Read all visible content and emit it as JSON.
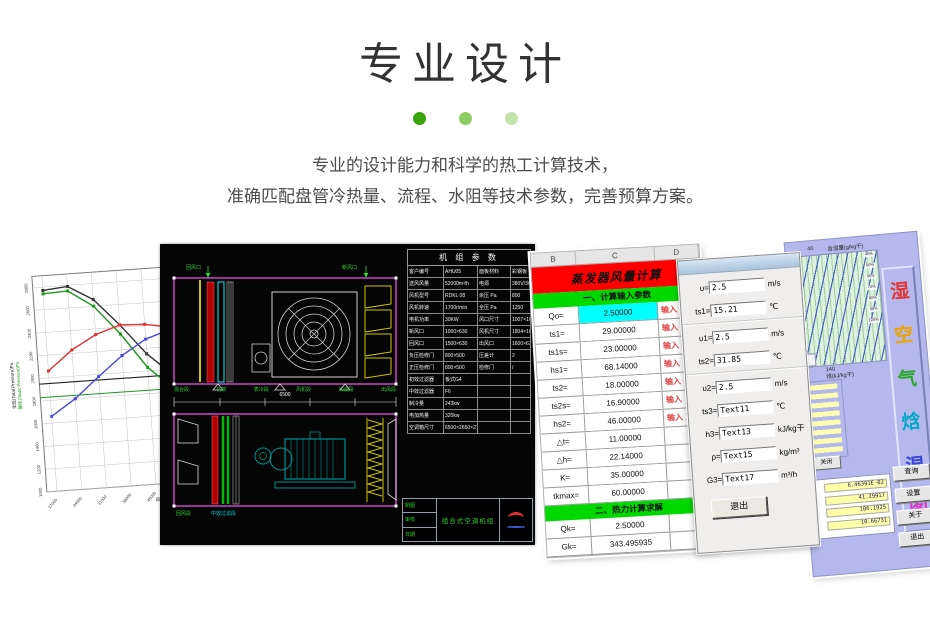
{
  "page": {
    "title": "专业设计",
    "dots": [
      {
        "color": "#3aa30b"
      },
      {
        "color": "#8fcc66"
      },
      {
        "color": "#c3e3a9"
      }
    ],
    "description_lines": [
      "专业的设计能力和科学的热工计算技术，",
      "准确匹配盘管冷热量、流程、水阻等技术参数，完善预算方案。"
    ]
  },
  "fan_chart": {
    "chart_data": {
      "type": "line",
      "title": "风机性能曲线",
      "xlabel": "风量(Volume)m³/h",
      "ylabel_left": "全压(Total Pressure)Pa",
      "ylabel_left2": "静压(Static Pressure)Pa",
      "x": [
        17000,
        24000,
        31000,
        38000,
        45000,
        52000
      ],
      "ylim": [
        1000,
        2900
      ],
      "y_ticks": [
        1000,
        1200,
        1400,
        1600,
        1800,
        2000,
        2200,
        2400,
        2600,
        2800
      ],
      "grid": true,
      "series": [
        {
          "name": "全压曲线",
          "color": "#333333",
          "values": [
            2770,
            2790,
            2660,
            2420,
            2150,
            1950
          ]
        },
        {
          "name": "静压曲线",
          "color": "#1a9a1a",
          "values": [
            2740,
            2750,
            2600,
            2340,
            2030,
            1830
          ]
        },
        {
          "name": "效率曲线",
          "color": "#e03030",
          "values": [
            2060,
            2230,
            2350,
            2420,
            2410,
            2370
          ]
        },
        {
          "name": "功率曲线",
          "color": "#4848e0",
          "values": [
            1660,
            1800,
            1980,
            2150,
            2280,
            2350
          ]
        }
      ],
      "ref_lines": {
        "total_pressure": 1950,
        "static_pressure": 1830,
        "flow": 52000
      }
    }
  },
  "cad": {
    "window_labels": {
      "left": "回风口",
      "right": "新风口"
    },
    "unit_top_labels": [
      {
        "text": "混合段",
        "color": "#2ecc2e"
      },
      {
        "text": "初效",
        "color": "#2ecc2e"
      },
      {
        "text": "表冷段",
        "color": "#2ecc2e"
      },
      {
        "text": "风机段",
        "color": "#2ecc2e"
      },
      {
        "text": "均流段",
        "color": "#2ecc2e"
      },
      {
        "text": "出风段",
        "color": "#2ecc2e"
      }
    ],
    "unit_bottom_labels": [
      {
        "text": "回风段",
        "color": "#2ecc2e"
      },
      {
        "text": "中效过滤段",
        "color": "#00cccc"
      }
    ],
    "dim_total": "6500",
    "table": {
      "title": "机 组 参 数",
      "rows": [
        [
          "客户编号",
          "AHU05",
          "面板材料",
          "彩钢板"
        ],
        [
          "送风风量",
          "52000m³/h",
          "电源",
          "380V/3/50"
        ],
        [
          "风机型号",
          "RDKL 08",
          "余压 Pa",
          "800"
        ],
        [
          "风机转速",
          "1700r/min",
          "全压 Pa",
          "1250"
        ],
        [
          "电机功率",
          "30KW",
          "风口尺寸",
          "1007×1007"
        ],
        [
          "新风口",
          "1000×630",
          "风机尺寸",
          "1804×1007"
        ],
        [
          "回风口",
          "1500×630",
          "出风口",
          "1600×630"
        ],
        [
          "负压检修门",
          "800×500",
          "压差计",
          "2"
        ],
        [
          "正压检修门",
          "800×500",
          "检修门",
          "/"
        ],
        [
          "初效过滤器",
          "板式G4",
          "",
          ""
        ],
        [
          "中效过滤器",
          "F6",
          "",
          ""
        ],
        [
          "制冷量",
          "243kw",
          "",
          ""
        ],
        [
          "电加热量",
          "320kw",
          "",
          ""
        ],
        [
          "空调箱尺寸",
          "6500×2650×2750(H)",
          "",
          ""
        ]
      ]
    },
    "title_block": {
      "cells": [
        "制图",
        "审核",
        "日期"
      ],
      "product": "组合式空调机组"
    }
  },
  "sheet": {
    "columns": [
      "B",
      "C",
      "D"
    ],
    "title": "蒸发器风量计算",
    "section1": "一、计算输入参数",
    "section2": "二、热力计算求解",
    "rows": [
      {
        "label": "Qo=",
        "value": "2.50000",
        "note": "输入",
        "bg": "#00ffff"
      },
      {
        "label": "ts1=",
        "value": "29.00000",
        "note": "输入",
        "bg": "#ffffff"
      },
      {
        "label": "ts1s=",
        "value": "23.00000",
        "note": "输入",
        "bg": "#ffffff"
      },
      {
        "label": "hs1=",
        "value": "68.14000",
        "note": "输入",
        "bg": "#ffffff"
      },
      {
        "label": "ts2=",
        "value": "18.00000",
        "note": "输入",
        "bg": "#ffffff"
      },
      {
        "label": "ts2s=",
        "value": "16.90000",
        "note": "输入",
        "bg": "#ffffff"
      },
      {
        "label": "hs2=",
        "value": "46.00000",
        "note": "输入",
        "bg": "#ffffff"
      },
      {
        "label": "△t=",
        "value": "11.00000",
        "note": "",
        "bg": "#ffffff"
      },
      {
        "label": "△h=",
        "value": "22.14000",
        "note": "",
        "bg": "#ffffff"
      },
      {
        "label": "K=",
        "value": "35.00000",
        "note": "",
        "bg": "#ffffff"
      },
      {
        "label": "tkmax=",
        "value": "60.00000",
        "note": "",
        "bg": "#ffffff"
      }
    ],
    "result_rows": [
      {
        "label": "Qk=",
        "value": "2.50000"
      },
      {
        "label": "Gk=",
        "value": "343.495935"
      }
    ]
  },
  "dialog": {
    "fields": [
      {
        "label": "υ=",
        "value": "2.5",
        "unit": "m/s"
      },
      {
        "label": "ts1=",
        "value": "15.21",
        "unit": "℃"
      },
      {
        "label": "υ1=",
        "value": "2.5",
        "unit": "m/s"
      },
      {
        "label": "ts2=",
        "value": "31.85",
        "unit": "℃"
      },
      {
        "label": "υ2=",
        "value": "2.5",
        "unit": "m/s"
      },
      {
        "label": "ts3=",
        "value": "Text11",
        "unit": "℃"
      },
      {
        "label": "h3=",
        "value": "Text13",
        "unit": "kJ/kg干"
      },
      {
        "label": "ρ=",
        "value": "Text15",
        "unit": "kg/m³"
      },
      {
        "label": "G3=",
        "value": "Text17",
        "unit": "m³/h"
      }
    ],
    "exit_button": "退出"
  },
  "psych": {
    "x_tick_top": "40",
    "top_label": "含湿量(g/kg干)",
    "enthalpy_tick": "140",
    "bottom_label": "焓(kJ/kg干)",
    "rh_labels": [
      "40%",
      "50%",
      "60%",
      "70%",
      "80%",
      "90%",
      "100%"
    ],
    "title_chars": [
      {
        "ch": "湿",
        "color": "#e23535"
      },
      {
        "ch": "空",
        "color": "#f0a400"
      },
      {
        "ch": "气",
        "color": "#28a428"
      },
      {
        "ch": "焓",
        "color": "#00a8c8"
      },
      {
        "ch": "湿",
        "color": "#3846d8"
      },
      {
        "ch": "图",
        "color": "#d838c8"
      }
    ],
    "close_button": "关闭",
    "values": [
      "6.46391E-02",
      "41.29917",
      "106.1925",
      "10.66731"
    ],
    "buttons": [
      "查询",
      "设置",
      "关于",
      "退出"
    ]
  }
}
